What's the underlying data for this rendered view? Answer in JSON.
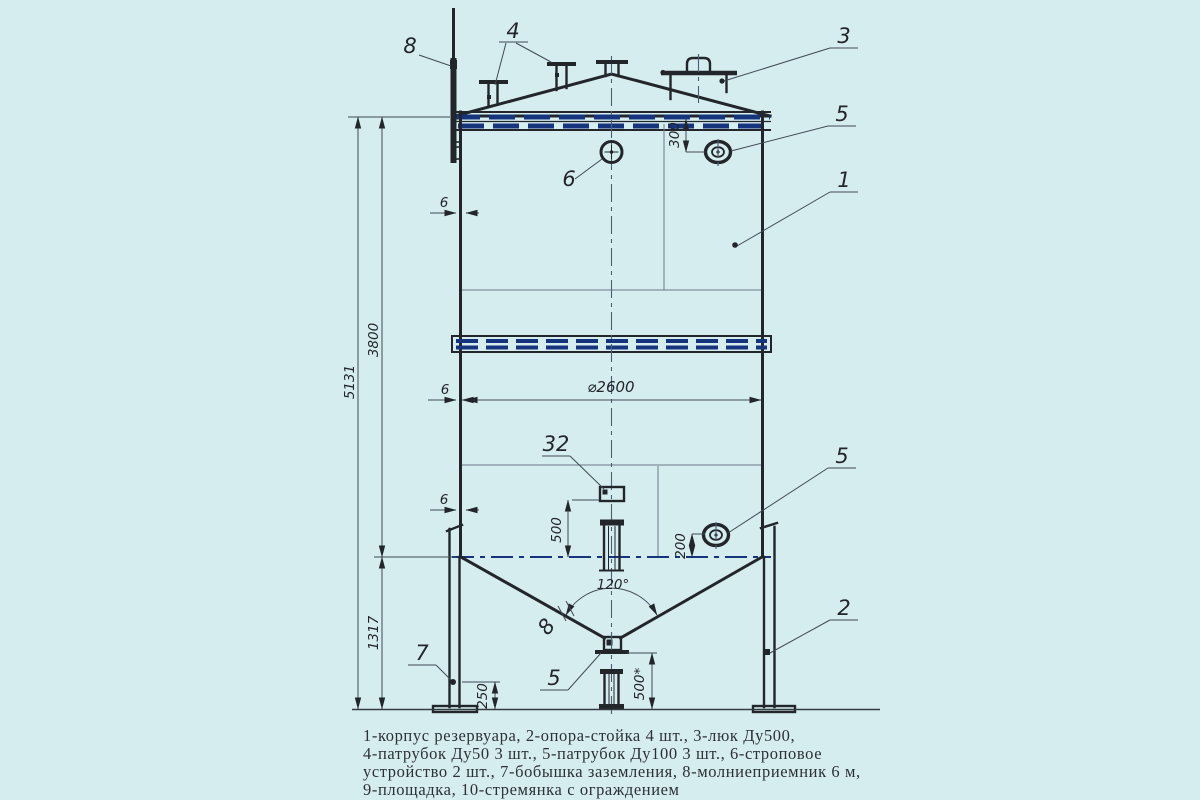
{
  "callouts": {
    "body": "1",
    "support": "2",
    "manhole": "3",
    "roof_nozzles": "4",
    "nozzle_top": "5",
    "nozzle_mid": "5",
    "nozzle_bottom": "5",
    "sling": "6",
    "ground_boss": "7",
    "lightning_rod": "8",
    "cone_thickness": "8",
    "item32": "32"
  },
  "dimensions": {
    "overall_height": "5131",
    "shell_height": "3800",
    "bottom_height": "1317",
    "top_offset": "300",
    "wall_thk_1": "6",
    "wall_thk_2": "6",
    "wall_thk_3": "6",
    "diameter": "⌀2600",
    "mid_offset": "500",
    "side_offset": "200",
    "boss_height": "250",
    "outlet_height": "500*",
    "cone_angle": "120°"
  },
  "legend": {
    "line1": "1-корпус резервуара, 2-опора-стойка 4 шт., 3-люк Ду500,",
    "line2": "4-патрубок Ду50 3 шт., 5-патрубок Ду100 3 шт., 6-строповое",
    "line3": "устройство 2 шт., 7-бобышка заземления, 8-молниеприемник 6 м,",
    "line4": "9-площадка, 10-стремянка с ограждением"
  }
}
